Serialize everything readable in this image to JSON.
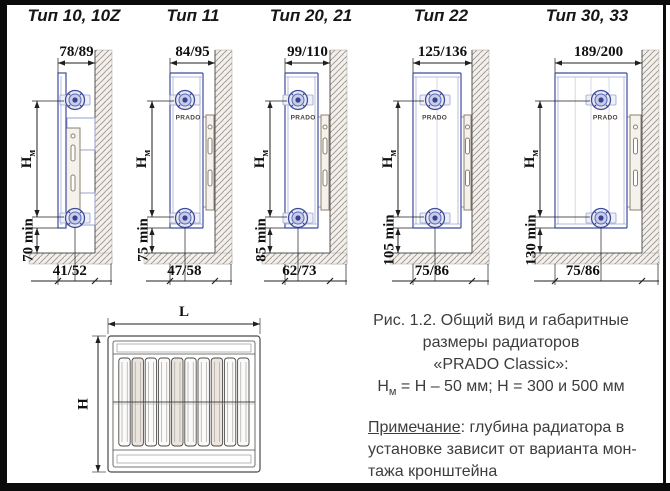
{
  "panels": [
    {
      "title": "Тип 10, 10Z",
      "top_dim": "78/89",
      "height_label": "Н",
      "height_sub": "м",
      "min_label": "70 min",
      "bottom_dim": "41/52",
      "brand": ""
    },
    {
      "title": "Тип 11",
      "top_dim": "84/95",
      "height_label": "Н",
      "height_sub": "м",
      "min_label": "75 min",
      "bottom_dim": "47/58",
      "brand": "PRADO"
    },
    {
      "title": "Тип 20, 21",
      "top_dim": "99/110",
      "height_label": "Н",
      "height_sub": "м",
      "min_label": "85 min",
      "bottom_dim": "62/73",
      "brand": "PRADO"
    },
    {
      "title": "Тип 22",
      "top_dim": "125/136",
      "height_label": "Н",
      "height_sub": "м",
      "min_label": "105 min",
      "bottom_dim": "75/86",
      "brand": "PRADO"
    },
    {
      "title": "Тип 30, 33",
      "top_dim": "189/200",
      "height_label": "Н",
      "height_sub": "м",
      "min_label": "130 min",
      "bottom_dim": "75/86",
      "brand": "PRADO"
    }
  ],
  "front_view": {
    "width_label": "L",
    "height_label": "H"
  },
  "caption": {
    "line1": "Рис. 1.2. Общий вид и габаритные",
    "line2": "размеры радиаторов",
    "line3": "«PRADO Classic»:",
    "formula_h": "Н",
    "formula_sub": "м",
    "formula_rest": " = Н – 50 мм;  Н = 300 и 500 мм"
  },
  "note": {
    "label": "Примечание",
    "line1_rest": ": глубина радиатора в",
    "line2": "установке зависит от варианта мон-",
    "line3": "тажа кронштейна"
  },
  "colors": {
    "dimension_line": "#1f1f1f",
    "radiator_blue": "#3f4c9e",
    "radiator_light": "#99a2cd",
    "bracket_steel": "#8d8072",
    "hatch": "#9c948b",
    "hatch_bg": "#f2efec",
    "front_line": "#4a4a4a",
    "text_grey": "#3d3d3d"
  }
}
